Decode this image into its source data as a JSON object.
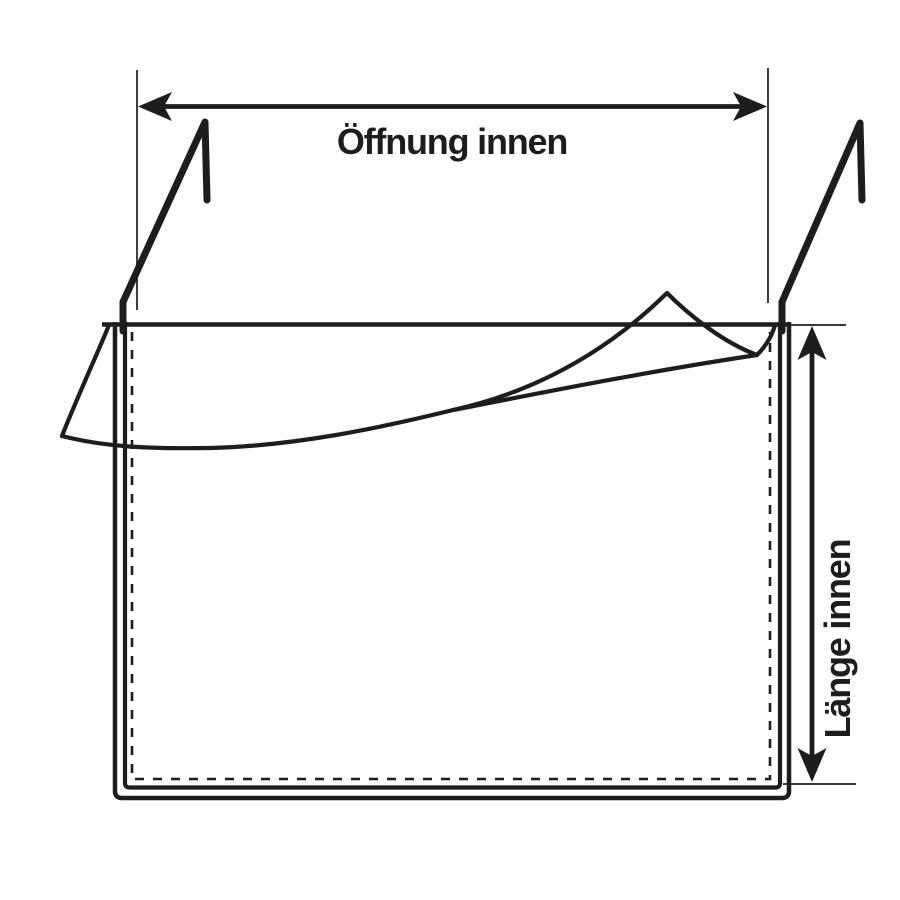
{
  "page": {
    "background_color": "#ffffff",
    "ink_color": "#1d1d1b"
  },
  "diagram": {
    "type": "technical-line-drawing",
    "subject": "hanging pouch with fold-over flap and two hanging hooks",
    "dimensions": [
      {
        "id": "opening",
        "label": "Öffnung innen",
        "orientation": "horizontal",
        "position": "top"
      },
      {
        "id": "length",
        "label": "Länge innen",
        "orientation": "vertical",
        "position": "right"
      }
    ]
  }
}
